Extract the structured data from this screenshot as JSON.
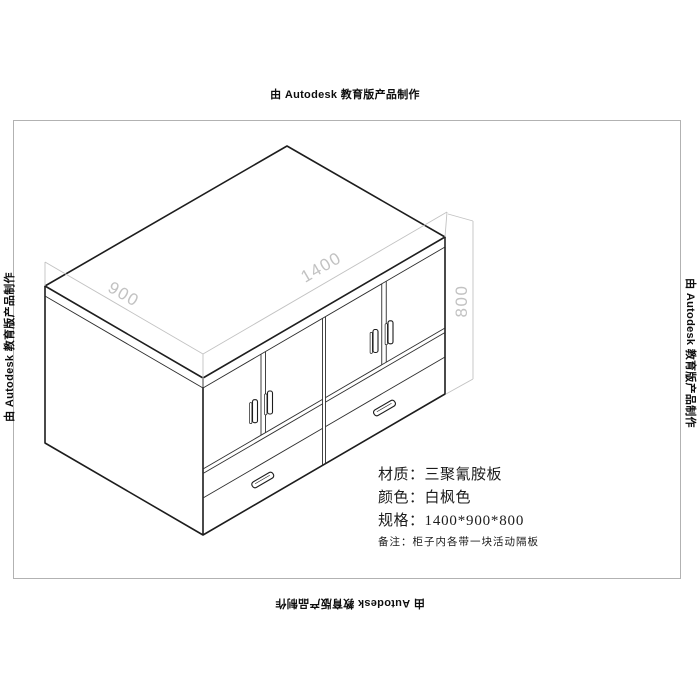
{
  "watermark": {
    "text": "由 Autodesk 教育版产品制作"
  },
  "dimensions": {
    "width_label": "1400",
    "depth_label": "900",
    "height_label": "800"
  },
  "specs": {
    "rows": [
      {
        "label": "材质：",
        "value": "三聚氰胺板"
      },
      {
        "label": "颜色：",
        "value": "白枫色"
      },
      {
        "label": "规格：",
        "value": "1400*900*800"
      },
      {
        "label": "备注：",
        "value": "柜子内各带一块活动隔板"
      }
    ]
  },
  "colors": {
    "outline": "#1d1d1d",
    "thin_line": "#2e2e2e",
    "dimension": "#c2c2c2",
    "sheet_border": "#b2b2b2",
    "watermark_text": "#0d0d0d",
    "spec_text": "#1c1c1c"
  }
}
